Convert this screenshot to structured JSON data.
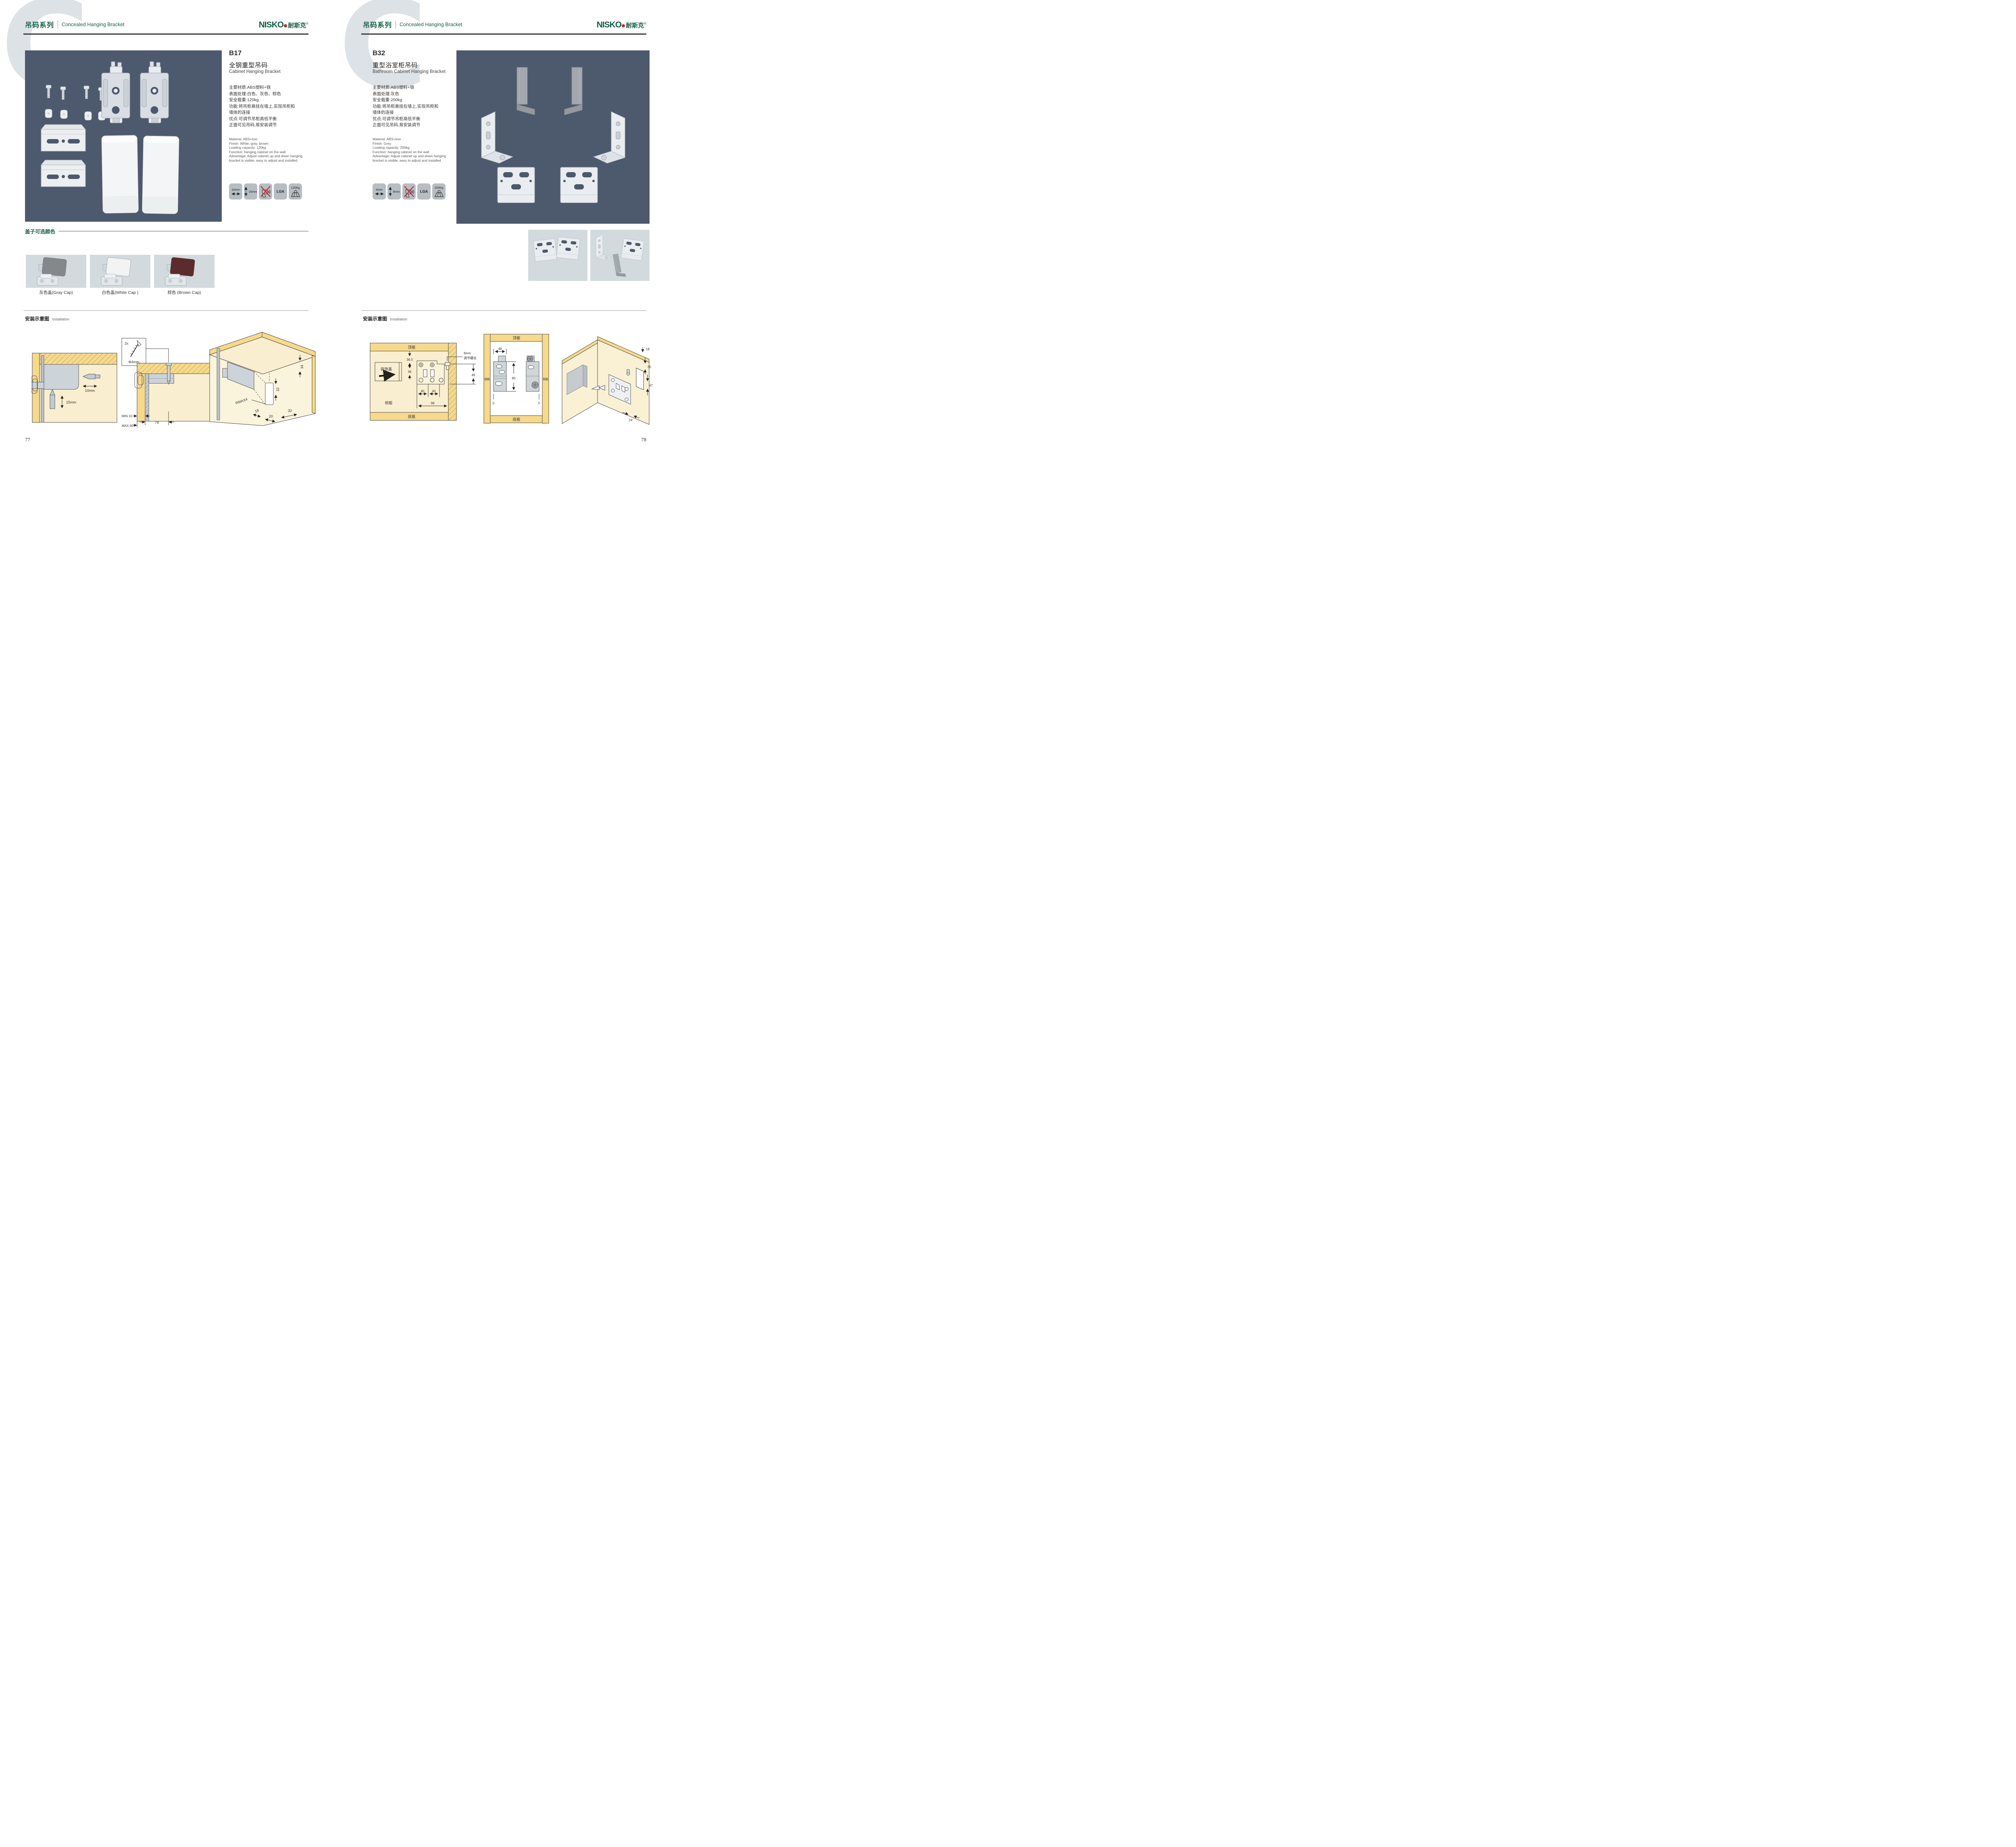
{
  "header": {
    "letter": "C",
    "series_cn": "吊码系列",
    "series_en": "Concealed Hanging Bracket",
    "brand_en": "NISKO",
    "brand_cn": "耐斯克",
    "reg": "®"
  },
  "page_left": {
    "page_number": "77",
    "product": {
      "code": "B17",
      "name_cn": "全钢重型吊码",
      "name_en": "Cabinet Hanging Bracket",
      "specs_cn": [
        "主要材质:ABS塑料+铁",
        "表面处理:白色、灰色、棕色",
        "安全载重:120kg",
        "功能:将吊柜悬挂在墙上,实现吊柜和",
        "墙体的连接",
        "优点:可调节吊柜高低平衡",
        "正面可见吊码,易安装调节"
      ],
      "specs_en": [
        "Material: ABS+iron",
        "Finish: White, gray, brown",
        "Loading capacity: 120kg",
        "Function: hanging cabinet on the wall",
        "Advantage: Adjust cabinet up and down hanging",
        "bracket is visible, easy to adjust and installed"
      ],
      "icons": {
        "i1": "10mm",
        "i2": "15mm",
        "i4": "LGA",
        "i5": "120Kg"
      }
    },
    "caps": {
      "title": "盖子可选颜色",
      "labels": [
        "灰色盖(Gray Cap)",
        "白色盖(White Cap )",
        "棕色 (Brown Cap)"
      ],
      "colors": [
        "#85888a",
        "#f2f4f4",
        "#5c2b2d"
      ]
    },
    "install": {
      "title_cn": "安装示意图",
      "title_en": "Installation",
      "d1": {
        "dh": "10mm",
        "dv": "15mm"
      },
      "d2": {
        "qty": "2x",
        "dia": "Φ4mm",
        "t": "13",
        "min": "MIN.10",
        "max": "MAX.30",
        "w": "78"
      },
      "d3": {
        "a": "34",
        "b": "32",
        "r": "RMAX4",
        "c": "18",
        "d": "20",
        "e": "32"
      }
    }
  },
  "page_right": {
    "page_number": "78",
    "product": {
      "code": "B32",
      "name_cn": "重型浴室柜吊码",
      "name_en": "Bathroom Cabinet Hanging Bracket",
      "specs_cn": [
        "主要材质:ABS塑料+铁",
        "表面处理:灰色",
        "安全载重:200kg",
        "功能:将吊柜悬挂在墙上,实现吊柜和",
        "墙体的连接",
        "优点:可调节吊柜高低平衡",
        "正面可见吊码,易安装调节"
      ],
      "specs_en": [
        "Material: ABS+iron",
        "Finish: Grey",
        "Loading capacity: 200kg",
        "Function: hanging cabinet on the wall",
        "Advantage: Adjust cabinet up and down hanging",
        "bracket is visible, easy to adjust and installed"
      ],
      "icons": {
        "i1": "4mm",
        "i2": "8mm",
        "i4": "LGA",
        "i5": "200Kg"
      }
    },
    "install": {
      "title_cn": "安装示意图",
      "title_en": "Installation",
      "d1": {
        "top": "顶板",
        "bottom": "底板",
        "side": "侧板",
        "cover": "装饰盖",
        "a": "36.5",
        "b": "36",
        "c": "40",
        "d": "40",
        "e": "98",
        "s1": "8mm",
        "s2": "调节螺丝",
        "f": "48"
      },
      "d2": {
        "top": "顶板",
        "bottom": "底板",
        "side": "侧板",
        "a": "48",
        "b": "80",
        "c": "5",
        "d": "5"
      },
      "d3": {
        "a": "18",
        "b": "35",
        "c": "47",
        "d": "24"
      }
    }
  },
  "colors": {
    "green": "#176148",
    "red": "#c1272d",
    "photo_bg": "#4d596d",
    "light_bg": "#d3dadd"
  }
}
